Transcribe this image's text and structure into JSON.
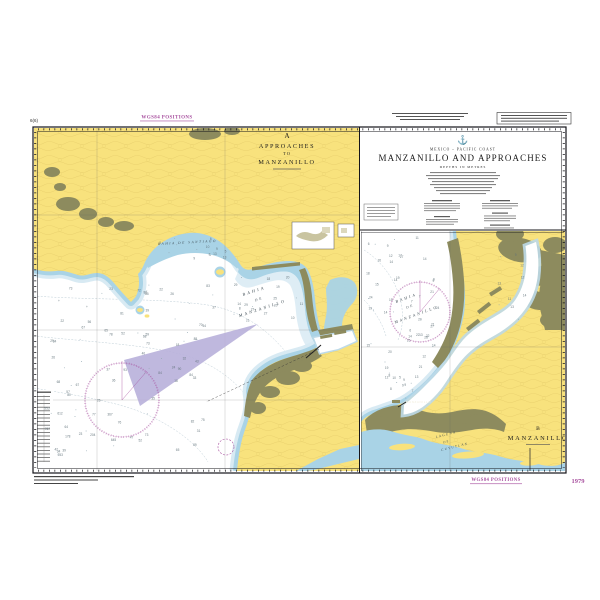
{
  "chart": {
    "number": "1979",
    "corner_ref": "6(6)",
    "wgs84_label": "WGS84 POSITIONS",
    "country_line": "MEXICO – PACIFIC COAST",
    "main_title": "MANZANILLO AND APPROACHES",
    "depths_note": "DEPTHS IN METRES",
    "crest_icon": "⚓"
  },
  "panel_a": {
    "letter": "A",
    "l1": "APPROACHES",
    "l2": "TO",
    "l3": "MANZANILLO",
    "labels": {
      "santiago": "BAHIA DE SANTIAGO",
      "bz1": "BAHIA",
      "bz2": "DE",
      "bz3": "MANZANILLO"
    }
  },
  "panel_b": {
    "letter": "B",
    "title": "MANZANILLO",
    "labels": {
      "bz1": "BAHIA",
      "bz2": "DE",
      "bz3": "MANZANILLO",
      "lg1": "LAGUNA",
      "lg2": "DE",
      "lg3": "CUYUTLAN",
      "town": "MANZANILLO"
    }
  },
  "colors": {
    "land": "#f8e27d",
    "urban": "#8d8b5e",
    "shallow": "#a9d3e6",
    "pale": "#d8eaf3",
    "magenta": "#a8509f",
    "lavender": "#b8b0da"
  }
}
